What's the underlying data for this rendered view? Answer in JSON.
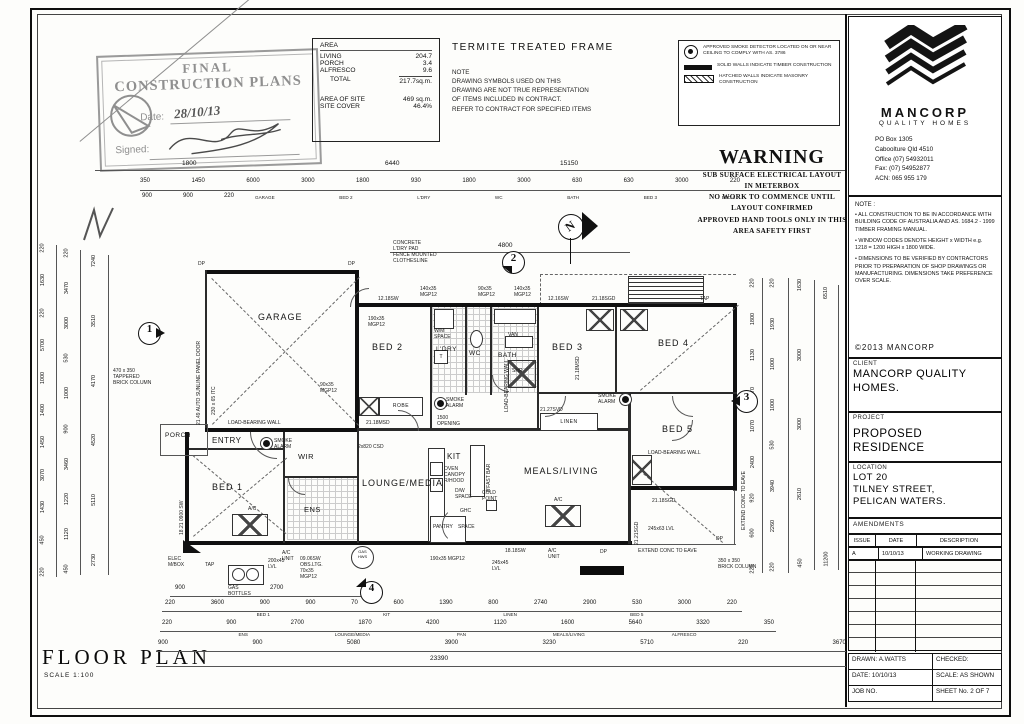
{
  "stamp": {
    "line1": "FINAL",
    "line2": "CONSTRUCTION PLANS",
    "date_label": "Date:",
    "date": "28/10/13",
    "signed_label": "Signed:"
  },
  "area_table": {
    "title": "AREA",
    "rows": [
      [
        "LIVING",
        "204.7"
      ],
      [
        "PORCH",
        "3.4"
      ],
      [
        "ALFRESCO",
        "9.6"
      ]
    ],
    "total_label": "TOTAL",
    "total": "217.7sq.m.",
    "site_rows": [
      [
        "AREA OF SITE",
        "469 sq.m."
      ],
      [
        "SITE COVER",
        "46.4%"
      ]
    ]
  },
  "termite": {
    "title": "TERMITE TREATED FRAME",
    "note": "NOTE\nDRAWING SYMBOLS USED ON THIS\nDRAWING ARE NOT TRUE REPRESENTATION\nOF ITEMS INCLUDED IN CONTRACT.\nREFER TO CONTRACT FOR SPECIFIED ITEMS"
  },
  "legend": {
    "items": [
      "APPROVED SMOKE DETECTOR LOCATED ON OR NEAR CEILING TO COMPLY WITH AS. 3786",
      "SOLID WALLS INDICATE TIMBER CONSTRUCTION",
      "HATCHED WALLS INDICATE MASONRY CONSTRUCTION"
    ]
  },
  "warning": {
    "title": "WARNING",
    "lines": [
      "SUB SURFACE ELECTRICAL LAYOUT",
      "IN METERBOX",
      "NO WORK TO COMMENCE UNTIL",
      "LAYOUT CONFIRMED",
      "APPROVED HAND TOOLS ONLY IN THIS",
      "AREA      SAFETY FIRST"
    ]
  },
  "brand": {
    "name": "MANCORP",
    "tagline": "QUALITY HOMES",
    "address": [
      "PO Box 1305",
      "Caboolture Qld 4510",
      "Office (07) 54932011",
      "Fax: (07) 54952877",
      "ACN: 065 955 179"
    ]
  },
  "notes": {
    "label": "NOTE :",
    "bullets": [
      "• ALL CONSTRUCTION TO BE IN ACCORDANCE WITH BUILDING CODE OF AUSTRALIA AND AS. 1684.2 - 1999 TIMBER FRAMING MANUAL.",
      "• WINDOW CODES DENOTE HEIGHT x WIDTH e.g. 1218 = 1200 HIGH x 1800 WIDE.",
      "• DIMENSIONS TO BE VERIFIED BY CONTRACTORS PRIOR TO PREPARATION OF SHOP DRAWINGS OR MANUFACTURING. DIMENSIONS TAKE PREFERENCE OVER SCALE."
    ],
    "copyright": "©2013  MANCORP"
  },
  "titleblock": {
    "client_label": "CLIENT",
    "client": "MANCORP QUALITY HOMES.",
    "project_label": "PROJECT",
    "project": "PROPOSED RESIDENCE",
    "location_label": "LOCATION",
    "location_lines": [
      "LOT 20",
      "TILNEY STREET,",
      "PELICAN WATERS."
    ],
    "amendments_label": "AMENDMENTS",
    "amend_headers": [
      "ISSUE",
      "DATE",
      "DESCRIPTION"
    ],
    "amend_row": [
      "A",
      "10/10/13",
      "WORKING DRAWING"
    ],
    "footer": {
      "drawn_label": "DRAWN:",
      "drawn": "A.WATTS",
      "checked_label": "CHECKED:",
      "date_label": "DATE:",
      "date": "10/10/13",
      "scale_label": "SCALE:",
      "scale": "AS SHOWN",
      "job_label": "JOB NO.",
      "sheet_label": "SHEET No.",
      "sheet": "2 OF 7"
    }
  },
  "floor_title": {
    "title": "FLOOR PLAN",
    "scale": "SCALE 1:100"
  },
  "plan": {
    "rooms": {
      "garage": "GARAGE",
      "porch": "PORCH",
      "entry": "ENTRY",
      "bed1": "BED 1",
      "wir": "WIR",
      "ens": "ENS",
      "lounge": "LOUNGE/MEDIA",
      "kit": "KIT",
      "meals": "MEALS/LIVING",
      "bed2": "BED 2",
      "ldry": "L'DRY",
      "wc": "WC",
      "bath": "BATH",
      "bed3": "BED 3",
      "bed4": "BED 4",
      "bed5": "BED 5",
      "linen": "LINEN",
      "pantry": "PANTRY",
      "robe": "ROBE"
    },
    "markers": {
      "m1": "1",
      "m2": "2",
      "m3": "3",
      "m4": "4",
      "north": "N"
    },
    "ann": {
      "concrete": "CONCRETE\nL'DRY PAD\nFENCE MOUNTED\nCLOTHESLINE",
      "garage_door": "21.49 AUTO SUNLINE PANEL DOOR",
      "itc": "230 x 65 ITC",
      "bed1win": "18.21 0900 SW",
      "tapered_col": "470 x 350\nTAPPERED\nBRICK COLUMN",
      "brick_col": "350 x 350\nBRICK COLUMN",
      "lbw1": "LOAD-BEARING WALL",
      "lbw2": "LOAD-BEARING WALL",
      "lbw3": "LOAD-BEARING WALL",
      "extend1": "EXTEND CONC TO EAVE",
      "extend2": "EXTEND CONC TO EAVE",
      "opening": "1500\nOPENING",
      "w1": "12.18SW",
      "w2": "21.18SGD",
      "w7": "12.16SW",
      "w3": "21.18MSD",
      "w4": "21.18MSD",
      "w5": "21.27SVD",
      "w6": "18.18SW",
      "w8": "21.18SGD",
      "w9": "21.21SGD",
      "w11": "2x820 CSD",
      "mgpA": "140x35\nMGP12",
      "mgpB": "90x35\nMGP12",
      "mgpC": "140x35\nMGP12",
      "mgpD": "190x35\nMGP12",
      "mgpE": "90x35\nMGP12",
      "mgpF": "190x35 MGP12",
      "lvl200": "200x45\nLVL",
      "lvl245": "245x45\nLVL",
      "lvl245b": "245x63 LVL",
      "obs": "09.06SW\nOBS.LTG.\n70x35\nMGP12",
      "elec": "ELEC\nM/BOX",
      "tap": "TAP",
      "tap2": "TAP",
      "gas_bottles": "GAS\nBOTTLES",
      "ac1": "A/C",
      "ac1u": "A/C\nUNIT",
      "ac2": "A/C",
      "ac2u": "A/C\nUNIT",
      "gas_hws": "GAS\nHWS",
      "cold": "COLD\nPOINT",
      "ghc": "GHC",
      "fridge": "SPACE",
      "oven": "OVEN\nCANOPY\nR/HOOD",
      "dw": "D/W\nSPACE",
      "bfast": "B'FAST BAR",
      "wm": "W/M\nSPACE",
      "van": "VAN",
      "shr": "SHR",
      "smoke1": "SMOKE\nALARM",
      "smoke2": "SMOKE\nALARM",
      "smoke3": "SMOKE\nALARM",
      "dp1": "DP",
      "dp2": "DP",
      "dp3": "DP",
      "dp4": "DP"
    },
    "dims": {
      "top1": [
        "1800",
        "6440",
        "15150"
      ],
      "top2": [
        "350",
        "1450",
        "6000",
        "3000",
        "1800",
        "930",
        "1800",
        "3000",
        "630",
        "630",
        "3000",
        "220"
      ],
      "top3_left": [
        "900",
        "900",
        "220"
      ],
      "top_names": [
        "GARAGE",
        "BED 2",
        "L'DRY",
        "WC",
        "BATH",
        "BED 3",
        "BED 4"
      ],
      "top_4800": "4800",
      "bottom1": [
        "900",
        "2700",
        "70"
      ],
      "bottom2": [
        "220",
        "3600",
        "900",
        "900",
        "70",
        "600",
        "1390",
        "800",
        "2740",
        "2900",
        "530",
        "3000",
        "220"
      ],
      "bottom2_names": [
        "BED 1",
        "KIT",
        "LINEN",
        "BED 5"
      ],
      "bottom3": [
        "220",
        "900",
        "2700",
        "1870",
        "4200",
        "1120",
        "1600",
        "5640",
        "3320",
        "350"
      ],
      "bottom3_names": [
        "ENS",
        "LOUNGE/MEDIA",
        "PAN",
        "MEALS/LIVING",
        "ALFRESCO"
      ],
      "bottom4": [
        "900",
        "900",
        "5080",
        "3900",
        "3230",
        "5710",
        "220",
        "3670"
      ],
      "total": "23390",
      "left_col1": [
        "220",
        "1630",
        "220",
        "5700",
        "1000",
        "1400",
        "1450",
        "3070",
        "1430",
        "450",
        "220"
      ],
      "left_col2": [
        "220",
        "3470",
        "3000",
        "530",
        "1000",
        "900",
        "3460",
        "1220",
        "1120",
        "450"
      ],
      "left_col3": [
        "7240",
        "3510",
        "4170",
        "4520",
        "5110",
        "2730"
      ],
      "right_col1": [
        "220",
        "1800",
        "1130",
        "70",
        "1070",
        "2400",
        "920",
        "600",
        "220"
      ],
      "right_col2": [
        "220",
        "1930",
        "1000",
        "1000",
        "530",
        "3940",
        "2260",
        "220"
      ],
      "right_col3": [
        "1630",
        "3000",
        "3000",
        "2610",
        "450"
      ],
      "right_col4": [
        "6510",
        "11200"
      ]
    }
  }
}
